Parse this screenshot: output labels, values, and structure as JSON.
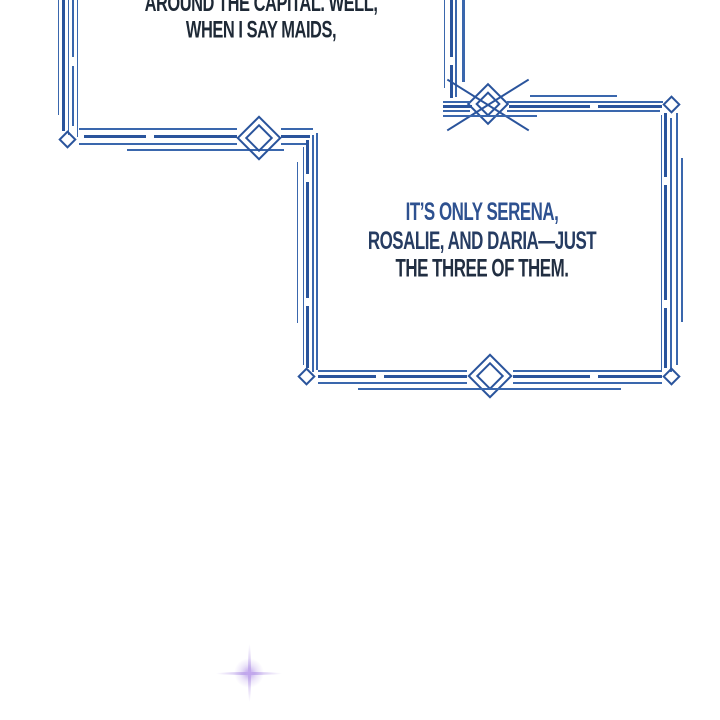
{
  "colors": {
    "background": "#ffffff",
    "border-blue": "#3a67ad",
    "border-blue-dark": "#2a549c",
    "bubble1-text": "#1e2936",
    "bubble2-line1": "#2e5190",
    "bubble2-line2": "#263c62",
    "bubble2-line3": "#212e41",
    "sparkle": "#ab8ce4"
  },
  "bubble1": {
    "lines": [
      "AROUND THE CAPITAL. WELL,",
      "WHEN I SAY MAIDS,"
    ]
  },
  "bubble2": {
    "lines": [
      "IT’S ONLY SERENA,",
      "ROSALIE, AND DARIA—JUST",
      "THE THREE OF THEM."
    ]
  },
  "sparkle": {
    "name": "four-point-sparkle"
  }
}
